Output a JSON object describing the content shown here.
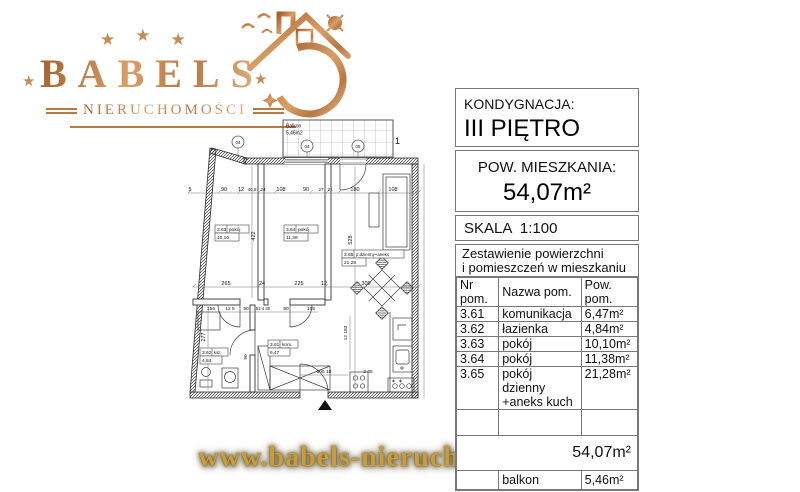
{
  "logo": {
    "brand": "BABELS",
    "subtitle": "NIERUCHOMOŚCI",
    "star": "★",
    "stars_top": [
      "★",
      "★",
      "★"
    ],
    "accent_color": "#bf8150"
  },
  "footer": {
    "website": "www.babels-nieruchomosci.pl",
    "gold_color": "#c79d3d"
  },
  "info_panel": {
    "floor_label": "KONDYGNACJA:",
    "floor_value": "III PIĘTRO",
    "area_label": "POW. MIESZKANIA:",
    "area_value": "54,07m²",
    "scale_label": "SKALA  1:100",
    "table_title_1": "Zestawienie powierzchni",
    "table_title_2": "i pomieszczeń w mieszkaniu",
    "col_nr": "Nr pom.",
    "col_name": "Nazwa pom.",
    "col_area": "Pow. pom.",
    "rows": [
      {
        "nr": "3.61",
        "name": "komunikacja",
        "area": "6,47m²"
      },
      {
        "nr": "3.62",
        "name": "łazienka",
        "area": "4,84m²"
      },
      {
        "nr": "3.63",
        "name": "pokój",
        "area": "10,10m²"
      },
      {
        "nr": "3.64",
        "name": "pokój",
        "area": "11,38m²"
      },
      {
        "nr": "3.65",
        "name": "pokój dzienny",
        "name2": "+aneks kuch",
        "area": "21,28m²"
      }
    ],
    "total_area": "54,07m²",
    "balcony_name": "balkon",
    "balcony_area": "5,46m²"
  },
  "plan": {
    "balcony_label_1": "Balkon",
    "balcony_label_2": "5,46m2",
    "markers": [
      "04",
      "04",
      "05"
    ],
    "rooms": [
      {
        "id": "3.63",
        "type": "pokój",
        "area": "10,10"
      },
      {
        "id": "3.64",
        "type": "pokój",
        "area": "11,38"
      },
      {
        "id": "3.65",
        "type": "p.dzienny+aneks",
        "area": "21,28"
      },
      {
        "id": "3.62",
        "type": "łaz.",
        "area": "4,84"
      },
      {
        "id": "3.61",
        "type": "kom.",
        "area": "6,47"
      }
    ],
    "dims": [
      "5",
      "90",
      "12",
      "46,5",
      "24",
      "108",
      "90",
      "27",
      "21",
      "180",
      "108",
      "265",
      "24",
      "225",
      "12",
      "309",
      "156",
      "12 5",
      "90",
      "52 4 30",
      "90",
      "105",
      "105 10",
      "2 65",
      "422",
      "528",
      "277",
      "90",
      "12 183",
      "1"
    ]
  }
}
